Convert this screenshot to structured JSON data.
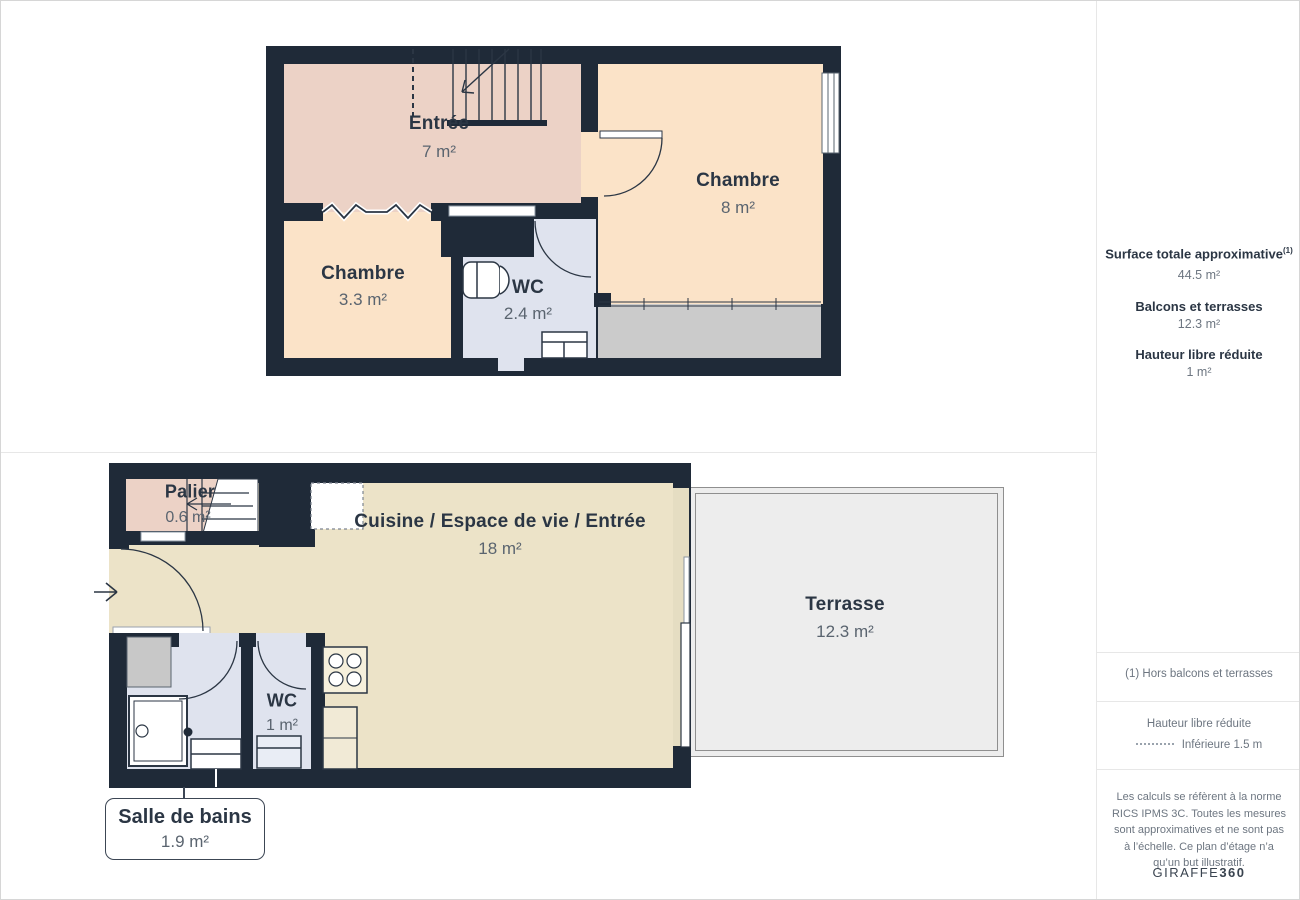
{
  "floor1": {
    "rooms": {
      "entree": {
        "name": "Entrée",
        "area": "7 m²"
      },
      "chambre_right": {
        "name": "Chambre",
        "area": "8 m²"
      },
      "chambre_left": {
        "name": "Chambre",
        "area": "3.3 m²"
      },
      "wc": {
        "name": "WC",
        "area": "2.4 m²"
      }
    }
  },
  "floor0": {
    "rooms": {
      "palier": {
        "name": "Palier",
        "area": "0.6 m²"
      },
      "cuisine": {
        "name": "Cuisine / Espace de vie / Entrée",
        "area": "18 m²"
      },
      "terrasse": {
        "name": "Terrasse",
        "area": "12.3 m²"
      },
      "wc": {
        "name": "WC",
        "area": "1 m²"
      },
      "salle_de_bains": {
        "name": "Salle de bains",
        "area": "1.9 m²"
      }
    }
  },
  "sidebar": {
    "surface_title": "Surface totale approximative",
    "surface_sup": "(1)",
    "surface_value": "44.5 m²",
    "balcons_title": "Balcons et terrasses",
    "balcons_value": "12.3 m²",
    "hauteur_title": "Hauteur libre réduite",
    "hauteur_value": "1 m²",
    "footnote": "(1) Hors balcons et terrasses",
    "legend_title": "Hauteur libre réduite",
    "legend_label": "Inférieure 1.5 m",
    "disclaimer": "Les calculs se réfèrent à la norme RICS IPMS 3C. Toutes les mesures sont approximatives et ne sont pas à l’échelle. Ce plan d’étage n’a qu’un but illustratif.",
    "brand_regular": "GIRAFFE",
    "brand_bold": "360"
  },
  "colors": {
    "wall": "#1f2a38",
    "floor_pink": "#ecd2c6",
    "floor_peach": "#fbe3c8",
    "floor_cream": "#ece3c8",
    "floor_blue": "#dfe3ee",
    "reduced_gray": "#cbcbcb",
    "terrace_gray": "#ededed",
    "label_dark": "#2b3644",
    "label_gray": "#5a646f"
  }
}
